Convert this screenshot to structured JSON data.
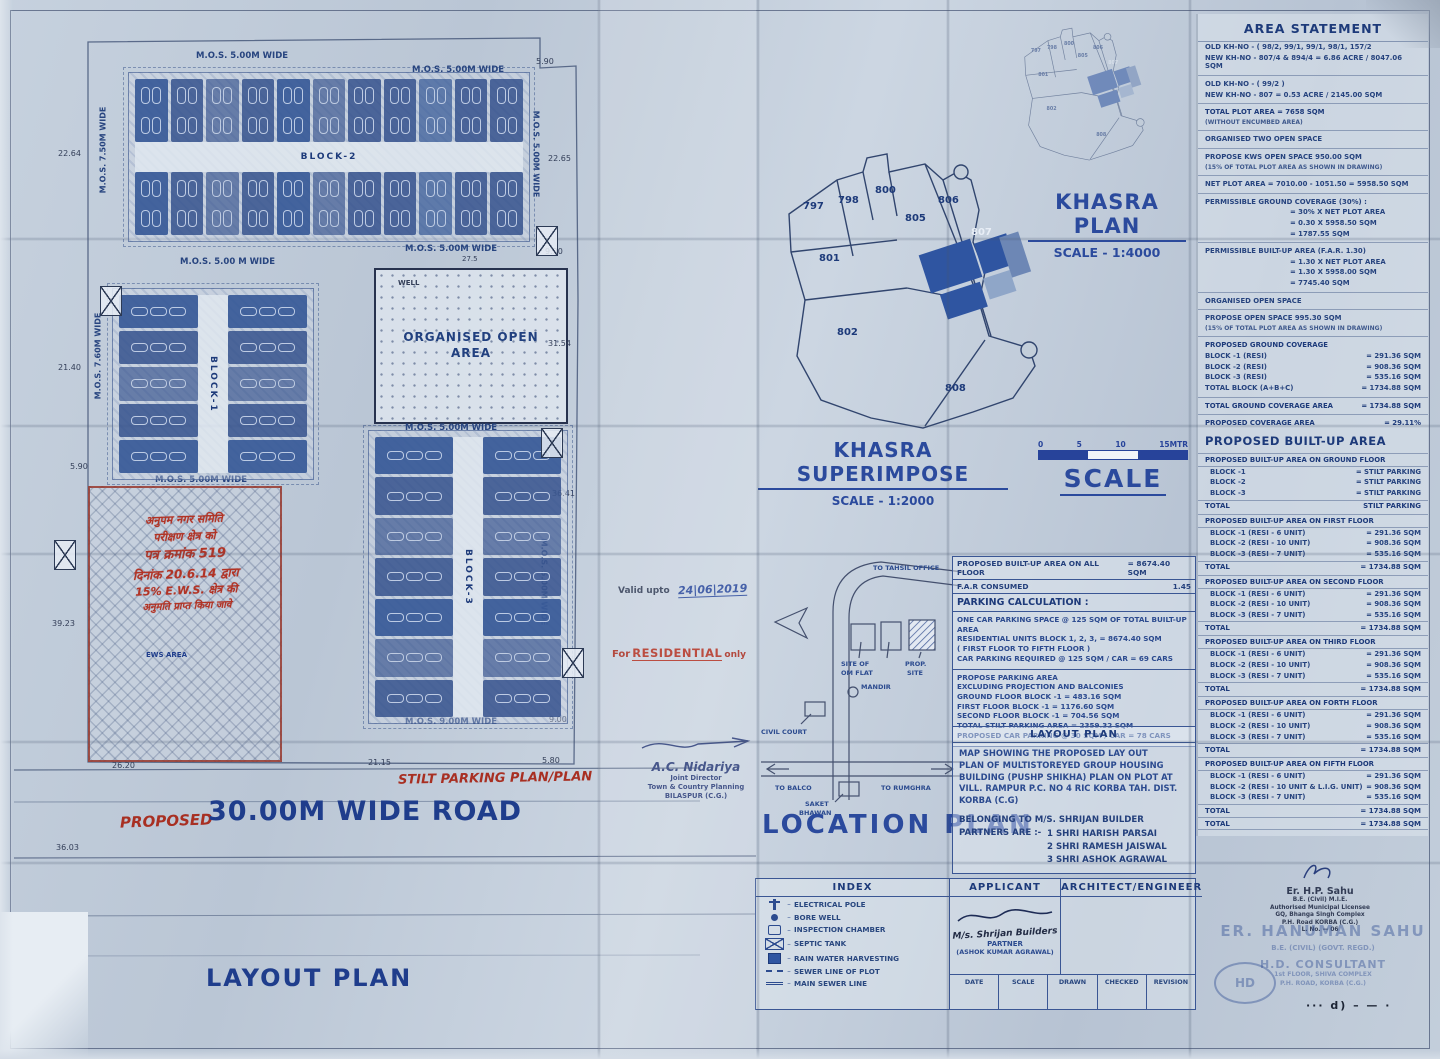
{
  "titles": {
    "area_statement": "AREA STATEMENT",
    "built_up": "PROPOSED BUILT-UP AREA",
    "khasra_plan": "KHASRA PLAN",
    "khasra_plan_scale": "SCALE - 1:4000",
    "khasra_superimpose": "KHASRA SUPERIMPOSE",
    "khasra_superimpose_scale": "SCALE - 1:2000",
    "scale_word": "SCALE",
    "location_plan": "LOCATION PLAN",
    "index": "INDEX",
    "applicant": "APPLICANT",
    "architect": "ARCHITECT/ENGINEER",
    "parking": "PARKING CALCULATION :"
  },
  "scale_bar": {
    "ticks": [
      "0",
      "5",
      "10",
      "15MTR"
    ]
  },
  "open_area": {
    "line1": "ORGANISED OPEN",
    "line2": "AREA"
  },
  "annotations": {
    "valid_label": "Valid upto",
    "valid_value": "24|06|2019",
    "res_pre": "For",
    "res_word": "RESIDENTIAL",
    "res_post": "only",
    "dash_marks": "··· d) – — ·"
  },
  "labels": [
    {
      "n": "mos-top-left-label",
      "t": "M.O.S. 5.00M WIDE",
      "x": 196,
      "y": 52,
      "s": 8.5
    },
    {
      "n": "mos-top-right-label",
      "t": "M.O.S. 5.00M WIDE",
      "x": 412,
      "y": 66,
      "s": 8.5
    },
    {
      "n": "mos-left-upper-label",
      "t": "M.O.S. 7.50M WIDE",
      "x": 60,
      "y": 146,
      "s": 8,
      "r": -90
    },
    {
      "n": "mos-right-block2-label",
      "t": "M.O.S. 5.00M WIDE",
      "x": 492,
      "y": 150,
      "s": 8,
      "r": 90
    },
    {
      "n": "mos-below-block2-left-label",
      "t": "M.O.S. 5.00 M WIDE",
      "x": 180,
      "y": 258,
      "s": 8.5
    },
    {
      "n": "mos-below-block2-right-label",
      "t": "M.O.S. 5.00M WIDE",
      "x": 405,
      "y": 245,
      "s": 8.5
    },
    {
      "n": "mos-block1-left-label",
      "t": "M.O.S. 7.60M WIDE",
      "x": 55,
      "y": 352,
      "s": 8,
      "r": -90
    },
    {
      "n": "mos-below-block1-label",
      "t": "M.O.S. 5.00M WIDE",
      "x": 155,
      "y": 476,
      "s": 8.5
    },
    {
      "n": "mos-above-block3-label",
      "t": "M.O.S. 5.00M WIDE",
      "x": 405,
      "y": 424,
      "s": 8.5
    },
    {
      "n": "mos-right-block3-label",
      "t": "M.O.S. 5.00M WIDE",
      "x": 500,
      "y": 578,
      "s": 8,
      "r": 90
    },
    {
      "n": "mos-below-block3-label",
      "t": "M.O.S. 9.00M WIDE",
      "x": 405,
      "y": 718,
      "s": 8.5
    },
    {
      "n": "well-label",
      "t": "WELL",
      "x": 398,
      "y": 280,
      "s": 7,
      "c": "dark"
    },
    {
      "n": "dim-22-64",
      "t": "22.64",
      "x": 58,
      "y": 150,
      "s": 8,
      "c": "dark",
      "b": 0
    },
    {
      "n": "dim-21-40",
      "t": "21.40",
      "x": 58,
      "y": 364,
      "s": 8,
      "c": "dark",
      "b": 0
    },
    {
      "n": "dim-5-90-left",
      "t": "5.90",
      "x": 70,
      "y": 463,
      "s": 8,
      "c": "dark",
      "b": 0
    },
    {
      "n": "dim-39-23",
      "t": "39.23",
      "x": 52,
      "y": 620,
      "s": 8,
      "c": "dark",
      "b": 0
    },
    {
      "n": "dim-36-03",
      "t": "36.03",
      "x": 56,
      "y": 844,
      "s": 8,
      "c": "dark",
      "b": 0
    },
    {
      "n": "dim-5-90-top",
      "t": "5.90",
      "x": 536,
      "y": 58,
      "s": 8,
      "c": "dark",
      "b": 0
    },
    {
      "n": "dim-22-65",
      "t": "22.65",
      "x": 548,
      "y": 155,
      "s": 8,
      "c": "dark",
      "b": 0
    },
    {
      "n": "dim-9-90",
      "t": "9.90",
      "x": 545,
      "y": 248,
      "s": 8,
      "c": "dark",
      "b": 0
    },
    {
      "n": "dim-31-54",
      "t": "31.54",
      "x": 548,
      "y": 340,
      "s": 8,
      "c": "dark",
      "b": 0
    },
    {
      "n": "dim-36-41",
      "t": "36.41",
      "x": 552,
      "y": 490,
      "s": 8,
      "c": "dark",
      "b": 0
    },
    {
      "n": "dim-9-00",
      "t": "9.00",
      "x": 549,
      "y": 716,
      "s": 8,
      "c": "dark",
      "b": 0
    },
    {
      "n": "dim-26-20",
      "t": "26.20",
      "x": 112,
      "y": 762,
      "s": 8,
      "c": "dark",
      "b": 0
    },
    {
      "n": "dim-21-15",
      "t": "21.15",
      "x": 368,
      "y": 759,
      "s": 8,
      "c": "dark",
      "b": 0
    },
    {
      "n": "dim-5-80",
      "t": "5.80",
      "x": 542,
      "y": 757,
      "s": 8,
      "c": "dark",
      "b": 0
    },
    {
      "n": "dim-27-5",
      "t": "27.5",
      "x": 462,
      "y": 256,
      "s": 7,
      "c": "dark",
      "b": 0
    },
    {
      "n": "ews-area-label",
      "t": "EWS AREA",
      "x": 146,
      "y": 652,
      "s": 7,
      "c": "navy"
    },
    {
      "n": "stilt-parking-note",
      "t": "STILT PARKING PLAN/PLAN",
      "x": 398,
      "y": 772,
      "s": 13,
      "c": "red",
      "i": 1,
      "r": -1
    },
    {
      "n": "proposed-red-note",
      "t": "PROPOSED",
      "x": 120,
      "y": 814,
      "s": 15,
      "c": "red",
      "i": 1,
      "r": -2
    },
    {
      "n": "road-title",
      "t": "30.00M WIDE ROAD",
      "x": 208,
      "y": 798,
      "s": 27,
      "c": "navy",
      "ls": 1
    },
    {
      "n": "layout-plan-title",
      "t": "LAYOUT PLAN",
      "x": 206,
      "y": 966,
      "s": 24,
      "c": "navy",
      "ls": 2
    }
  ],
  "blocks": [
    {
      "name": "block-2",
      "label": "BLOCK-2",
      "x": 128,
      "y": 72,
      "w": 400,
      "h": 168,
      "orient": "h",
      "cells": 11
    },
    {
      "name": "block-1",
      "label": "BLOCK-1",
      "x": 112,
      "y": 288,
      "w": 200,
      "h": 190,
      "orient": "v",
      "cells": 5
    },
    {
      "name": "block-3",
      "label": "BLOCK-3",
      "x": 368,
      "y": 430,
      "w": 198,
      "h": 292,
      "orient": "v",
      "cells": 7
    }
  ],
  "xboxes": [
    {
      "x": 100,
      "y": 286
    },
    {
      "x": 536,
      "y": 226
    },
    {
      "x": 541,
      "y": 428
    },
    {
      "x": 54,
      "y": 540
    },
    {
      "x": 562,
      "y": 648
    }
  ],
  "ews": {
    "lines": [
      {
        "t": "अनुपम नगर समिति",
        "s": 11
      },
      {
        "t": "परीक्षण क्षेत्र को",
        "s": 11
      },
      {
        "t": "पत्र क्रमांक 519",
        "s": 13
      },
      {
        "t": "दिनांक 20.6.14 द्वारा",
        "s": 12
      },
      {
        "t": "15% E.W.S. क्षेत्र की",
        "s": 11
      },
      {
        "t": "अनुमति प्राप्त किया जावे",
        "s": 10
      }
    ]
  },
  "khasra": {
    "plots": [
      {
        "t": "797",
        "x": 28,
        "y": 52
      },
      {
        "t": "798",
        "x": 63,
        "y": 46
      },
      {
        "t": "800",
        "x": 100,
        "y": 36
      },
      {
        "t": "805",
        "x": 130,
        "y": 64
      },
      {
        "t": "806",
        "x": 163,
        "y": 46
      },
      {
        "t": "807",
        "x": 196,
        "y": 78,
        "w": 1
      },
      {
        "t": "801",
        "x": 44,
        "y": 104
      },
      {
        "t": "802",
        "x": 62,
        "y": 178
      },
      {
        "t": "808",
        "x": 170,
        "y": 234
      }
    ]
  },
  "location": {
    "labels": [
      {
        "t": "TO TAHSIL OFFICE",
        "x": 118,
        "y": 12
      },
      {
        "t": "SITE OF",
        "x": 86,
        "y": 108
      },
      {
        "t": "OM FLAT",
        "x": 86,
        "y": 117
      },
      {
        "t": "PROP.",
        "x": 150,
        "y": 108
      },
      {
        "t": "SITE",
        "x": 152,
        "y": 117
      },
      {
        "t": "MANDIR",
        "x": 106,
        "y": 131
      },
      {
        "t": "CIVIL COURT",
        "x": 6,
        "y": 176
      },
      {
        "t": "TO BALCO",
        "x": 20,
        "y": 232
      },
      {
        "t": "TO RUMGHRA",
        "x": 126,
        "y": 232
      },
      {
        "t": "SAKET",
        "x": 50,
        "y": 248
      },
      {
        "t": "BHAWAN",
        "x": 44,
        "y": 257
      }
    ]
  },
  "ctable": {
    "builtup_all_label": "PROPOSED BUILT-UP AREA ON ALL FLOOR",
    "builtup_all_value": "= 8674.40 SQM",
    "far_label": "F.A.R CONSUMED",
    "far_value": "1.45",
    "p1": [
      "ONE CAR PARKING SPACE @ 125 SQM OF TOTAL BUILT-UP AREA",
      "RESIDENTIAL UNITS BLOCK 1, 2, 3,  = 8674.40 SQM",
      "( FIRST FLOOR TO FIFTH FLOOR )",
      "CAR PARKING REQUIRED @ 125 SQM / CAR = 69 CARS"
    ],
    "p2": [
      "PROPOSE PARKING AREA",
      "EXCLUDING PROJECTION AND BALCONIES",
      "GROUND FLOOR BLOCK -1        =  483.16 SQM",
      "FIRST FLOOR BLOCK -1           =  1176.60 SQM",
      "SECOND FLOOR BLOCK -1      =  704.56 SQM",
      "TOTAL STILT PARKING AREA   =  2359.32 SQM",
      "PROPOSED CAR PARKING @ 30 SQM / CAR = 78 CARS"
    ]
  },
  "lp_box": {
    "header": "LAYOUT PLAN",
    "para": [
      "MAP SHOWING THE PROPOSED LAY OUT",
      "PLAN OF MULTISTOREYED GROUP HOUSING",
      "BUILDING (PUSHP SHIKHA) PLAN ON PLOT AT",
      "VILL. RAMPUR P.C. NO 4 RIC KORBA TAH. DIST.",
      "KORBA   (C.G)"
    ],
    "belonging": "BELONGING TO M/S. SHRIJAN BUILDER",
    "partners_label": "PARTNERS ARE :-",
    "partners": [
      "1 SHRI HARISH PARSAI",
      "2 SHRI RAMESH JAISWAL",
      "3 SHRI ASHOK AGRAWAL"
    ]
  },
  "index_items": [
    {
      "icon": "electrical-pole-icon",
      "label": "ELECTRICAL POLE"
    },
    {
      "icon": "bore-well-icon",
      "label": "BORE WELL"
    },
    {
      "icon": "inspection-chamber-icon",
      "label": "INSPECTION CHAMBER"
    },
    {
      "icon": "septic-tank-icon",
      "label": "SEPTIC TANK"
    },
    {
      "icon": "rain-water-harvesting-icon",
      "label": "RAIN WATER HARVESTING"
    },
    {
      "icon": "sewer-line-icon",
      "label": "SEWER LINE OF PLOT"
    },
    {
      "icon": "main-sewer-icon",
      "label": "MAIN SEWER LINE"
    }
  ],
  "applicant_block": {
    "signature": "M/s. Shrijan Builders",
    "role": "PARTNER",
    "name": "(ASHOK KUMAR AGRAWAL)"
  },
  "titleblock": [
    "DATE",
    "SCALE",
    "DRAWN",
    "CHECKED",
    "REVISION"
  ],
  "area_statement": {
    "rows": [
      {
        "t": "OLD KH-NO  - ( 98/2, 99/1, 99/1, 98/1, 157/2"
      },
      {
        "t": "NEW KH-NO - 807/4 & 894/4 = 6.86 ACRE / 8047.06 SQM"
      },
      {
        "hr": true
      },
      {
        "t": "OLD KH-NO  - ( 99/2 )"
      },
      {
        "t": "NEW KH-NO - 807 = 0.53 ACRE / 2145.00 SQM"
      },
      {
        "hr": true
      },
      {
        "t": "TOTAL PLOT AREA  = 7658 SQM",
        "cls": "b"
      },
      {
        "t": "(WITHOUT ENCUMBED AREA)",
        "cls": "small"
      },
      {
        "hr": true
      },
      {
        "t": "ORGANISED TWO OPEN SPACE"
      },
      {
        "hr": true
      },
      {
        "t": "PROPOSE KWS OPEN SPACE  950.00 SQM"
      },
      {
        "t": "(15% OF TOTAL PLOT AREA AS SHOWN IN DRAWING)",
        "cls": "small"
      },
      {
        "hr": true
      },
      {
        "t": "NET PLOT AREA  = 7010.00 - 1051.50 = 5958.50 SQM"
      },
      {
        "hr": true
      },
      {
        "t": "PERMISSIBLE GROUND COVERAGE (30%) :"
      },
      {
        "t": "= 30% X NET PLOT AREA",
        "cls": "ind"
      },
      {
        "t": "= 0.30 X 5958.50 SQM",
        "cls": "ind"
      },
      {
        "t": "= 1787.55 SQM",
        "cls": "ind"
      },
      {
        "hr": true
      },
      {
        "t": "PERMISSIBLE BUILT-UP AREA (F.A.R. 1.30)"
      },
      {
        "t": "= 1.30 X NET PLOT AREA",
        "cls": "ind"
      },
      {
        "t": "= 1.30 X 5958.00 SQM",
        "cls": "ind"
      },
      {
        "t": "= 7745.40 SQM",
        "cls": "ind"
      },
      {
        "hr": true
      },
      {
        "t": "ORGANISED OPEN SPACE"
      },
      {
        "hr": true
      },
      {
        "t": "PROPOSE OPEN SPACE  995.30 SQM"
      },
      {
        "t": "(15% OF TOTAL PLOT AREA AS SHOWN IN DRAWING)",
        "cls": "small"
      },
      {
        "hr": true
      },
      {
        "t": "PROPOSED GROUND COVERAGE",
        "cls": "b"
      },
      {
        "t": "BLOCK -1 (RESI)",
        "v": "= 291.36 SQM"
      },
      {
        "t": "BLOCK -2 (RESI)",
        "v": "= 908.36 SQM"
      },
      {
        "t": "BLOCK -3 (RESI)",
        "v": "= 535.16 SQM"
      },
      {
        "t": "TOTAL BLOCK (A+B+C)",
        "v": "= 1734.88 SQM"
      },
      {
        "hr": true
      },
      {
        "t": "TOTAL GROUND COVERAGE AREA",
        "v": "= 1734.88 SQM",
        "cls": "b"
      },
      {
        "hr": true
      },
      {
        "t": "PROPOSED COVERAGE AREA",
        "v": "= 29.11%",
        "cls": "b"
      }
    ]
  },
  "built_up": {
    "floors": [
      {
        "h": "PROPOSED BUILT-UP AREA ON GROUND FLOOR",
        "rows": [
          [
            "BLOCK -1",
            "= STILT PARKING"
          ],
          [
            "BLOCK -2",
            "= STILT PARKING"
          ],
          [
            "BLOCK -3",
            "= STILT PARKING"
          ]
        ],
        "total": [
          "TOTAL",
          "STILT PARKING"
        ]
      },
      {
        "h": "PROPOSED BUILT-UP AREA ON FIRST FLOOR",
        "rows": [
          [
            "BLOCK -1 (RESI - 6 UNIT)",
            "= 291.36 SQM"
          ],
          [
            "BLOCK -2 (RESI - 10 UNIT)",
            "= 908.36 SQM"
          ],
          [
            "BLOCK -3 (RESI - 7 UNIT)",
            "= 535.16 SQM"
          ]
        ],
        "total": [
          "TOTAL",
          "= 1734.88 SQM"
        ]
      },
      {
        "h": "PROPOSED BUILT-UP AREA ON SECOND FLOOR",
        "rows": [
          [
            "BLOCK -1 (RESI - 6 UNIT)",
            "= 291.36 SQM"
          ],
          [
            "BLOCK -2 (RESI - 10 UNIT)",
            "= 908.36 SQM"
          ],
          [
            "BLOCK -3 (RESI - 7 UNIT)",
            "= 535.16 SQM"
          ]
        ],
        "total": [
          "TOTAL",
          "= 1734.88 SQM"
        ]
      },
      {
        "h": "PROPOSED BUILT-UP AREA ON THIRD FLOOR",
        "rows": [
          [
            "BLOCK -1 (RESI - 6 UNIT)",
            "= 291.36 SQM"
          ],
          [
            "BLOCK -2 (RESI - 10 UNIT)",
            "= 908.36 SQM"
          ],
          [
            "BLOCK -3 (RESI - 7 UNIT)",
            "= 535.16 SQM"
          ]
        ],
        "total": [
          "TOTAL",
          "= 1734.88 SQM"
        ]
      },
      {
        "h": "PROPOSED BUILT-UP AREA ON FORTH FLOOR",
        "rows": [
          [
            "BLOCK -1 (RESI - 6 UNIT)",
            "= 291.36 SQM"
          ],
          [
            "BLOCK -2 (RESI - 10 UNIT)",
            "= 908.36 SQM"
          ],
          [
            "BLOCK -3 (RESI - 7 UNIT)",
            "= 535.16 SQM"
          ]
        ],
        "total": [
          "TOTAL",
          "= 1734.88 SQM"
        ]
      },
      {
        "h": "PROPOSED BUILT-UP AREA ON FIFTH FLOOR",
        "rows": [
          [
            "BLOCK -1 (RESI - 6 UNIT)",
            "= 291.36 SQM"
          ],
          [
            "BLOCK -2 (RESI - 10 UNIT & L.I.G. UNIT)",
            "= 908.36 SQM"
          ],
          [
            "BLOCK -3 (RESI - 7 UNIT)",
            "= 535.16 SQM"
          ]
        ],
        "total": [
          "TOTAL",
          "= 1734.88 SQM"
        ]
      }
    ],
    "grand_total_label": "TOTAL",
    "grand_total_value": "= 1734.88 SQM"
  },
  "stamps": {
    "nidariya": {
      "name": "A.C. Nidariya",
      "lines": [
        "Joint Director",
        "Town & Country Planning",
        "BILASPUR (C.G.)"
      ]
    },
    "sahu": {
      "name": "Er. H.P. Sahu",
      "lines": [
        "B.E. (Civil) M.I.E.",
        "Authorised Municipal Licensee",
        "GQ, Bhanga Singh Complex",
        "P.H. Road KORBA (C.G.)",
        "L. No. — 06"
      ]
    },
    "hanuman": {
      "name": "ER. HANUMAN SAHU",
      "sub": "B.E. (CIVIL)  (GOVT. REGD.)",
      "firm": "H.D. CONSULTANT",
      "addr": [
        "1st FLOOR, SHIVA COMPLEX",
        "P.H. ROAD,  KORBA (C.G.)"
      ],
      "logo": "HD"
    }
  }
}
